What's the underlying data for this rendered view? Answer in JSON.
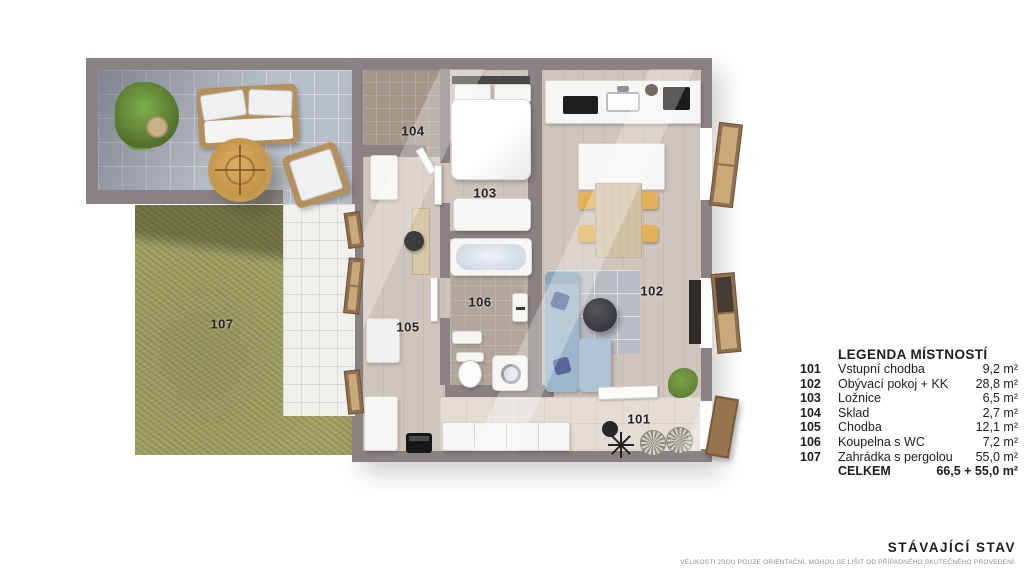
{
  "plan": {
    "labels": {
      "101": "101",
      "102": "102",
      "103": "103",
      "104": "104",
      "105": "105",
      "106": "106",
      "107": "107"
    }
  },
  "legend": {
    "title": "LEGENDA MÍSTNOSTÍ",
    "rows": [
      {
        "num": "101",
        "name": "Vstupní chodba",
        "area": "9,2 m²"
      },
      {
        "num": "102",
        "name": "Obývací pokoj + KK",
        "area": "28,8 m²"
      },
      {
        "num": "103",
        "name": "Ložnice",
        "area": "6,5 m²"
      },
      {
        "num": "104",
        "name": "Sklad",
        "area": "2,7 m²"
      },
      {
        "num": "105",
        "name": "Chodba",
        "area": "12,1 m²"
      },
      {
        "num": "106",
        "name": "Koupelna s WC",
        "area": "7,2 m²"
      },
      {
        "num": "107",
        "name": "Zahrádka s pergolou",
        "area": "55,0 m²"
      }
    ],
    "total": {
      "label": "CELKEM",
      "value": "66,5 + 55,0 m²"
    }
  },
  "footer": {
    "title": "STÁVAJÍCÍ STAV",
    "disclaimer": "VELIKOSTI JSOU POUZE ORIENTAČNÍ, MOHOU SE LIŠIT OD PŘÍPADNÉHO SKUTEČNÉHO PROVEDENÍ."
  },
  "colors": {
    "wall": "#8a8182",
    "grass": "#a2a266",
    "terrace_tile": "#b9bfc8",
    "wood_floor": "#cfc5bc",
    "sofa_blue": "#9eb6c9",
    "pillow_navy": "#56679b",
    "chair_yellow": "#e3b258",
    "window_frame": "#8f6f4d",
    "label_text": "#252525"
  }
}
